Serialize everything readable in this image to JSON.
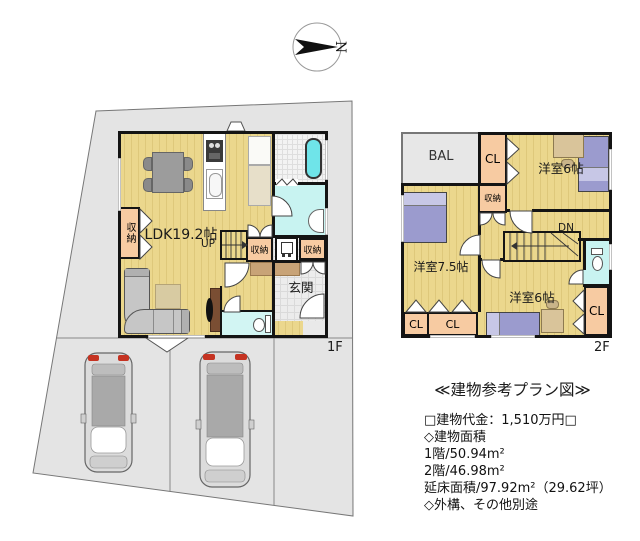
{
  "compass": {
    "north": "N"
  },
  "floor1": {
    "label": "1F",
    "ldk": "LDK19.2帖",
    "up": "UP",
    "closet_left": "収納",
    "closet_hall": "収納",
    "closet_entry": "収納",
    "entrance": "玄関"
  },
  "floor2": {
    "label": "2F",
    "balcony": "BAL",
    "closet_top": "CL",
    "bedroom_top": "洋室6帖",
    "storage": "収納",
    "bedroom_left": "洋室7.5帖",
    "down": "DN",
    "bedroom_bottom": "洋室6帖",
    "closet_bl1": "CL",
    "closet_bl2": "CL",
    "closet_br": "CL"
  },
  "info": {
    "title": "≪建物参考プラン図≫",
    "lines": [
      "□建物代金：1,510万円□",
      "◇建物面積",
      "1階/50.94m²",
      "2階/46.98m²",
      "延床面積/97.92m²（29.62坪）",
      "◇外構、その他別途"
    ]
  },
  "colors": {
    "floor": "#EBD78D",
    "closet": "#F7CBA2",
    "water": "#C8F3F1",
    "tub": "#6FE4E9",
    "bed": "#9B9BCE",
    "site": "#E4E4E4",
    "wall": "#141414"
  }
}
